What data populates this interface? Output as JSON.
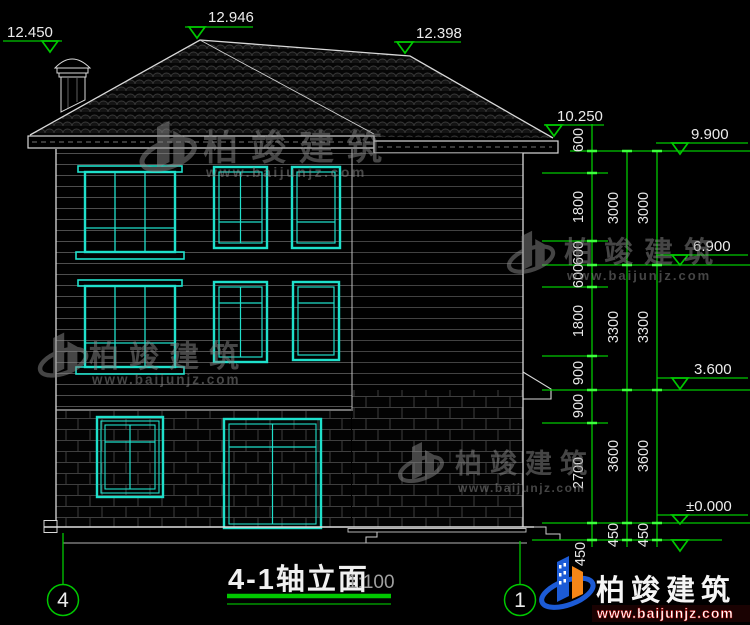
{
  "title_block": {
    "title": "4-1轴立面",
    "scale": "1:100"
  },
  "axes": {
    "left": "4",
    "right": "1"
  },
  "elevations": {
    "chimney_top": "12.450",
    "main_ridge": "12.946",
    "rear_ridge": "12.398",
    "eave": "10.250",
    "roof_level": "9.900",
    "third_floor": "6.900",
    "porch_ledge": "3.600",
    "ground": "±0.000"
  },
  "dims": {
    "inner": [
      "600",
      "1800",
      "600",
      "600",
      "1800",
      "900",
      "900",
      "2700",
      "450"
    ],
    "middle": [
      "3000",
      "3300",
      "3600",
      "450"
    ],
    "outer": [
      "3000",
      "3300",
      "3600",
      "450"
    ]
  },
  "watermark": {
    "name": "柏竣建筑",
    "url": "www.baijunjz.com"
  },
  "brand": {
    "name": "柏竣建筑",
    "url": "www.baijunjz.com"
  },
  "colors": {
    "dimension_green": "#00c800",
    "tick_green": "#3dff3d",
    "window_cyan": "#1fe0cb",
    "line_white": "#d9d9d9",
    "watermark_gray": "#8a8a8a",
    "brand_blue": "#1c5bd6",
    "brand_orange": "#f58617"
  }
}
